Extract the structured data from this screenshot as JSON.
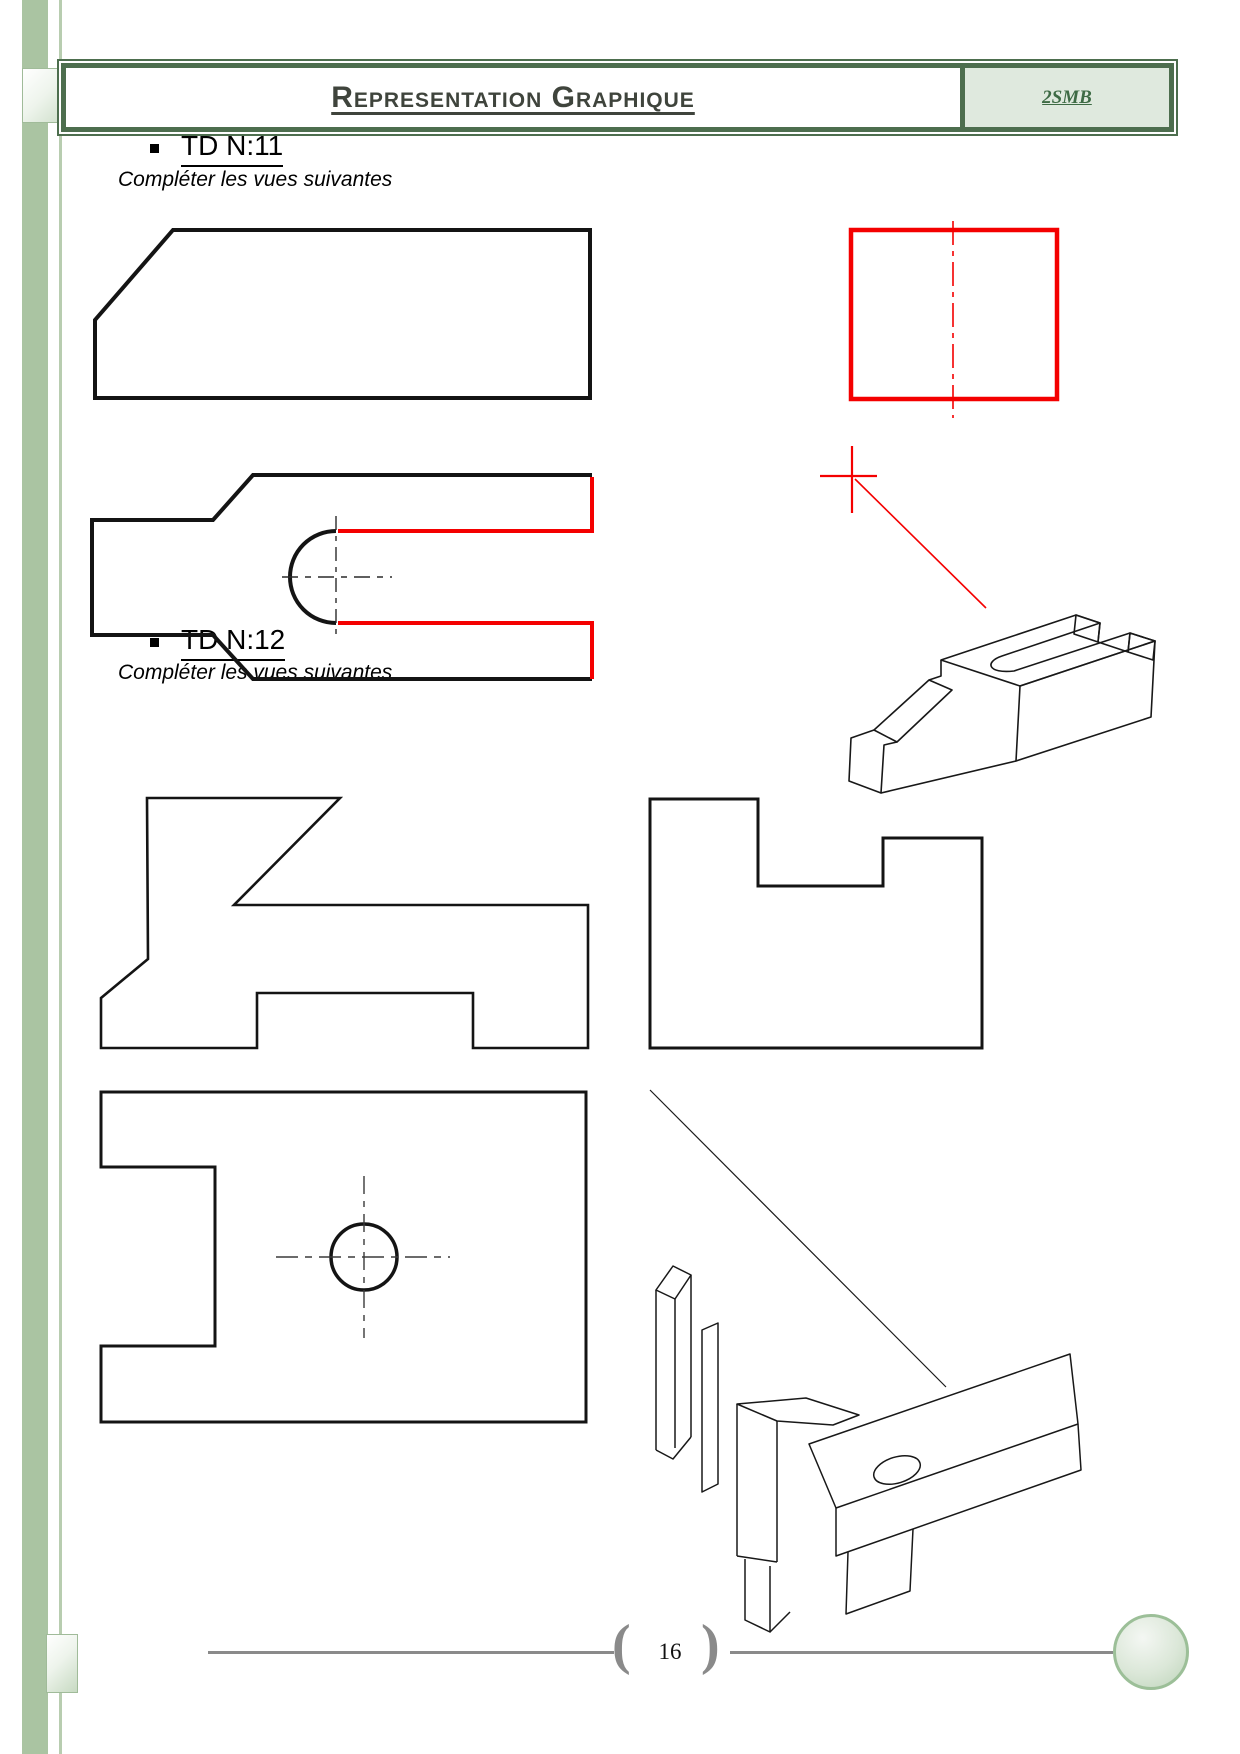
{
  "header": {
    "title": "Representation Graphique",
    "badge": "2SMB"
  },
  "sections": {
    "td11": {
      "title": "TD N:11",
      "instruction": "Compléter les vues suivantes"
    },
    "td12": {
      "title": "TD N:12",
      "instruction": "Compléter les vues suivantes"
    }
  },
  "footer": {
    "page_number": "16",
    "bracket_open": "(",
    "bracket_close": ")"
  },
  "colors": {
    "frame_green": "#4d6e4e",
    "badge_bg": "#dfe9de",
    "sidebar_green": "#aac4a2",
    "drawing_black": "#141414",
    "drawing_red": "#f40000",
    "footer_gray": "#8a8a8a",
    "circle_border": "#9cbf98"
  }
}
